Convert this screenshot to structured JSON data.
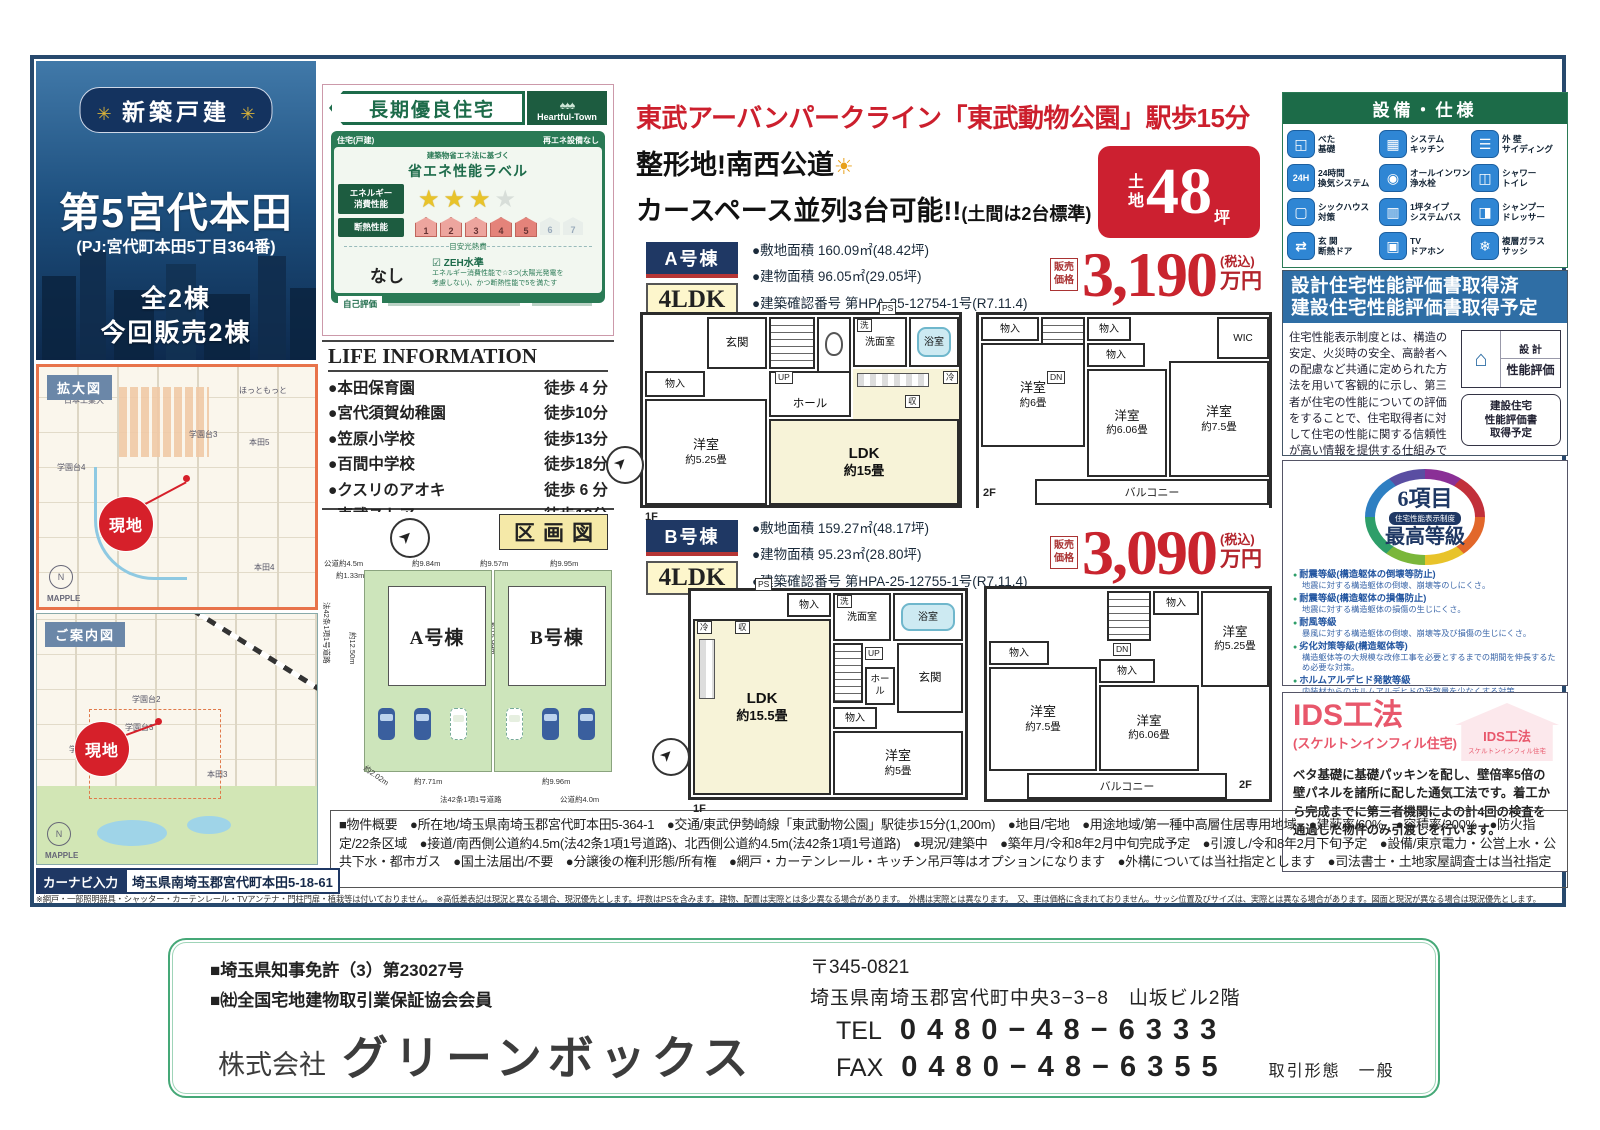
{
  "hero": {
    "badge": "新築戸建",
    "title": "第5宮代本田",
    "subtitle": "(PJ:宮代町本田5丁目364番)",
    "count1": "全2棟",
    "count2": "今回販売2棟"
  },
  "maps": {
    "enlarged_label": "拡大図",
    "guide_label": "ご案内図",
    "site": "現地",
    "mapple": "MAPPLE",
    "north": "N",
    "enlarged_places": [
      "学園台3",
      "学園台4",
      "本田5",
      "本田4",
      "ほっともっと",
      "日本工業大"
    ],
    "guide_places": [
      "学園台2",
      "学園台3",
      "学園台4",
      "本田3"
    ]
  },
  "navi": {
    "label": "カーナビ入力",
    "address": "埼玉県南埼玉郡宮代町本田5-18-61"
  },
  "choki": {
    "title": "長期優良住宅",
    "brand": "Heartful-Town",
    "brand_trees": "♠♠♠",
    "house_type": "住宅(戸建)",
    "no_renewable": "再エネ設備なし",
    "law": "建築物省エネ法に基づく",
    "label_title": "省エネ性能ラベル",
    "energy_l1": "エネルギー",
    "energy_l2": "消費性能",
    "stars_on": "★★★",
    "stars_off": "★",
    "insulation": "断熱性能",
    "levels": [
      "1",
      "2",
      "3",
      "4",
      "5",
      "6",
      "7"
    ],
    "cost_label": "目安光熱費",
    "cost_value": "なし",
    "zeh_check": "☑",
    "zeh": "ZEH水準",
    "zeh_note1": "エネルギー消費性能で☆3つ(太陽光発電を",
    "zeh_note2": "考慮しない)、かつ断熱性能で5を満たす",
    "self_eval": "自己評価"
  },
  "life": {
    "title": "LIFE INFORMATION",
    "items": [
      {
        "name": "●本田保育園",
        "time": "徒歩 4 分"
      },
      {
        "name": "●宮代須賀幼稚園",
        "time": "徒歩10分"
      },
      {
        "name": "●笠原小学校",
        "time": "徒歩13分"
      },
      {
        "name": "●百間中学校",
        "time": "徒歩18分"
      },
      {
        "name": "●クスリのアオキ",
        "time": "徒歩 6 分"
      },
      {
        "name": "●東武ストア",
        "time": "徒歩13分"
      }
    ]
  },
  "kukaku": {
    "title": "区画図",
    "a": "A号棟",
    "b": "B号棟",
    "top_road": "公道約4.5m",
    "offset": "約1.33m",
    "a_top": "約9.84m",
    "mid_top": "約9.57m",
    "b_top": "約9.95m",
    "left_len": "約12.50m",
    "mid_len": "約15.99m",
    "a_bottom": "約7.71m",
    "b_bottom": "約9.96m",
    "diag": "約2.02m",
    "left_road": "法42条1項1号道路",
    "bottom_road": "法42条1項1号道路",
    "right_road": "公道約4.0m"
  },
  "headline": {
    "line1": "東武アーバンパークライン「東武動物公園」駅歩15分",
    "line2": "整形地!南西公道",
    "sun": "☀",
    "line3": "カースペース並列3台可能!!",
    "line3_sub": "(土間は2台標準)",
    "land_t": "土",
    "land_c": "地",
    "land_value": "48",
    "land_unit": "坪"
  },
  "a": {
    "tag": "A号棟",
    "layout": "4LDK",
    "d1": "●敷地面積 160.09㎡(48.42坪)",
    "d2": "●建物面積 96.05㎡(29.05坪)",
    "d3": "●建築確認番号 第HPA-25-12754-1号(R7.11.4)",
    "price_l1": "販売",
    "price_l2": "価格",
    "price": "3,190",
    "tax": "(税込)",
    "unit": "万円"
  },
  "b": {
    "tag": "B号棟",
    "layout": "4LDK",
    "d1": "●敷地面積 159.27㎡(48.17坪)",
    "d2": "●建物面積 95.23㎡(28.80坪)",
    "d3": "●建築確認番号 第HPA-25-12755-1号(R7.11.4)",
    "price_l1": "販売",
    "price_l2": "価格",
    "price": "3,090",
    "tax": "(税込)",
    "unit": "万円"
  },
  "fp": {
    "a1f": {
      "genkan": "玄関",
      "hall": "ホール",
      "up": "UP",
      "ps": "PS",
      "wash": "洗",
      "rei": "冷",
      "shu": "収",
      "mono": "物入",
      "senmen": "洗面室",
      "bath": "浴室",
      "yo": "洋室",
      "yo_s": "約5.25畳",
      "ldk": "LDK",
      "ldk_s": "約15畳",
      "floor": "1F"
    },
    "a2f": {
      "mono1": "物入",
      "mono2": "物入",
      "mono3": "物入",
      "dn": "DN",
      "wic": "WIC",
      "r6": "洋室",
      "r6_s": "約6畳",
      "r606": "洋室",
      "r606_s": "約6.06畳",
      "r75": "洋室",
      "r75_s": "約7.5畳",
      "balcony": "バルコニー",
      "floor": "2F"
    },
    "b1f": {
      "rei": "冷",
      "ps": "PS",
      "shu": "収",
      "mono1": "物入",
      "mono2": "物入",
      "senmen": "洗面室",
      "wash": "洗",
      "bath": "浴室",
      "ldk": "LDK",
      "ldk_s": "約15.5畳",
      "hall": "ホール",
      "up": "UP",
      "genkan": "玄関",
      "r5": "洋室",
      "r5_s": "約5畳",
      "floor": "1F"
    },
    "b2f": {
      "dn": "DN",
      "mono1": "物入",
      "mono2": "物入",
      "mono3": "物入",
      "r525": "洋室",
      "r525_s": "約5.25畳",
      "r75": "洋室",
      "r75_s": "約7.5畳",
      "r606": "洋室",
      "r606_s": "約6.06畳",
      "balcony": "バルコニー",
      "floor": "2F"
    }
  },
  "equip": {
    "title": "設備・仕様",
    "items": [
      {
        "l1": "べた",
        "l2": "基礎"
      },
      {
        "l1": "システム",
        "l2": "キッチン"
      },
      {
        "l1": "外 壁",
        "l2": "サイディング"
      },
      {
        "l1": "24時間",
        "l2": "換気システム"
      },
      {
        "l1": "オールインワン",
        "l2": "浄水栓"
      },
      {
        "l1": "シャワー",
        "l2": "トイレ"
      },
      {
        "l1": "シックハウス",
        "l2": "対策"
      },
      {
        "l1": "1坪タイプ",
        "l2": "システムバス"
      },
      {
        "l1": "シャンプー",
        "l2": "ドレッサー"
      },
      {
        "l1": "玄 関",
        "l2": "断熱ドア"
      },
      {
        "l1": "TV",
        "l2": "ドアホン"
      },
      {
        "l1": "複層ガラス",
        "l2": "サッシ"
      }
    ]
  },
  "hyoka": {
    "h1": "設計住宅性能評価書取得済",
    "h2": "建設住宅性能評価書取得予定",
    "body": "住宅性能表示制度とは、構造の安定、火災時の安全、高齢者への配慮など共通に定められた方法を用いて客観的に示し、第三者が住宅の性能についての評価をすることで、住宅取得者に対して住宅の性能に関する信頼性が高い情報を提供する仕組みです。",
    "badge1a": "設 計",
    "badge1b": "性能評価",
    "badge2a": "建設住宅",
    "badge2b": "性能評価書",
    "badge2c": "取得予定"
  },
  "six": {
    "r1": "6項目",
    "r2": "住宅性能表示制度",
    "r3": "最高等級",
    "items": [
      {
        "t": "耐震等級(構造躯体の倒壊等防止)",
        "s": "地震に対する構造躯体の倒壊、崩壊等のしにくさ。"
      },
      {
        "t": "耐震等級(構造躯体の損傷防止)",
        "s": "地震に対する構造躯体の損傷の生じにくさ。"
      },
      {
        "t": "耐風等級",
        "s": "暴風に対する構造躯体の倒壊、崩壊等及び損傷の生じにくさ。"
      },
      {
        "t": "劣化対策等級(構造躯体等)",
        "s": "構造躯体等の大規模な改修工事を必要とするまでの期間を伸長するため必要な対策。"
      },
      {
        "t": "ホルムアルデヒド発散等級",
        "s": "内装材からのホルムアルデヒドの発散量を少なくする対策。"
      },
      {
        "t": "維持管理対策等級",
        "s": "専用の給排水管及びガス管の維持管理(清掃・点検及び補修)を容易とするために必要な対策。"
      }
    ]
  },
  "ids": {
    "title": "IDS工法",
    "sub": "(スケルトンインフィル住宅)",
    "badge1": "IDS工法",
    "badge2": "スケルトンインフィル住宅",
    "body": "ベタ基礎に基礎パッキンを配し、壁倍率5倍の壁パネルを諸所に配した通気工法です。着工から完成までに第三者機関によの計4回の検査を通過した物件のみ引渡しを行います。"
  },
  "overview": "■物件概要　●所在地/埼玉県南埼玉郡宮代町本田5-364-1　●交通/東武伊勢崎線「東武動物公園」駅徒歩15分(1,200m)　●地目/宅地　●用途地域/第一種中高層住居専用地域　●建蔽率/60%　●容積率/200%　●防火指定/22条区域　●接道/南西側公道約4.5m(法42条1項1号道路)、北西側公道約4.5m(法42条1項1号道路)　●現況/建築中　●築年月/令和8年2月中旬完成予定　●引渡し/令和8年2月下旬予定　●設備/東京電力・公営上水・公共下水・都市ガス　●国土法届出/不要　●分譲後の権利形態/所有権　●網戸・カーテンレール・キッチン吊戸等はオプションになります　●外構については当社指定とします　●司法書士・土地家屋調査士は当社指定",
  "fine_print": "※網戸・一部照明器具・シャッター・カーテンレール・TVアンテナ・門柱門扉・植栽等は付いておりません。　※高低差表記は現況と異なる場合、現況優先とします。坪数はPSを含みます。建物、配置は実際とは多少異なる場合があります。　外構は実際とは異なります。　又、車は価格に含まれておりません。サッシ位置及びサイズは、実際とは異なる場合があります。図面と現況が異なる場合は現況優先とします。",
  "footer": {
    "license1": "■埼玉県知事免許（3）第23027号",
    "license2": "■㈳全国宅地建物取引業保証協会会員",
    "company_prefix": "株式会社",
    "company": "グリーンボックス",
    "zip": "〒345-0821",
    "address": "埼玉県南埼玉郡宮代町中央3−3−8　山坂ビル2階",
    "tel_label": "TEL",
    "tel": "0480−48−6333",
    "fax_label": "FAX",
    "fax": "0480−48−6355",
    "deal": "取引形態　一般"
  }
}
